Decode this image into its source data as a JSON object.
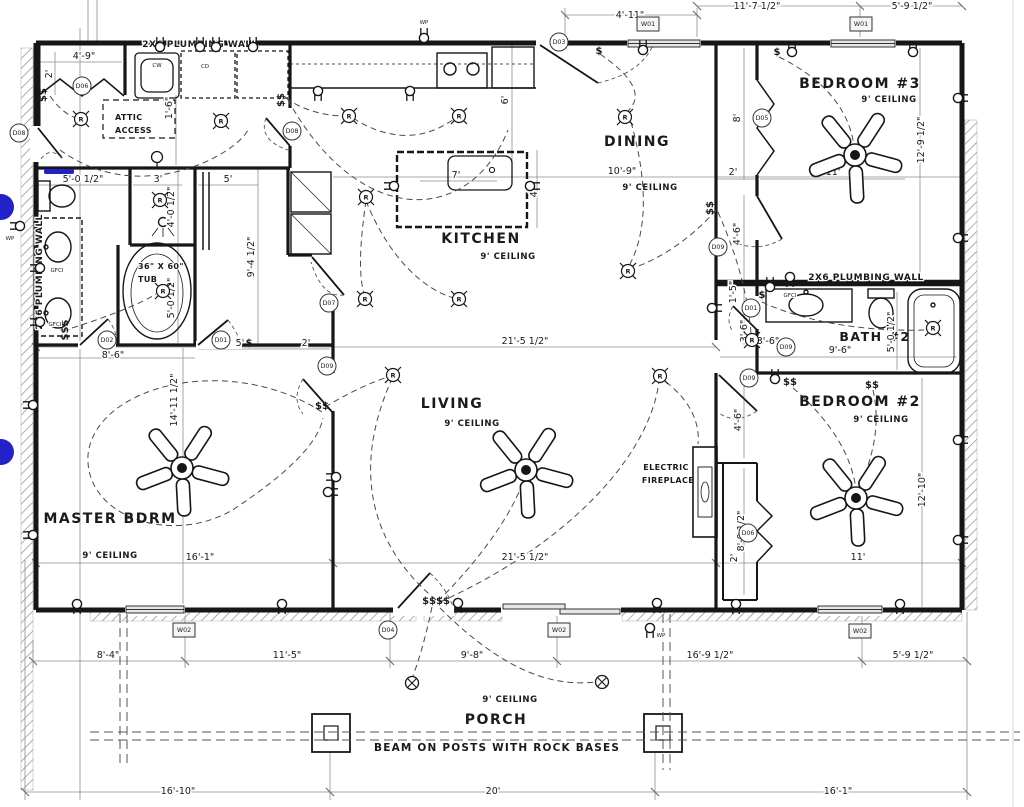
{
  "colors": {
    "ink": "#161616",
    "gray_line": "#8f8f8f",
    "window_fill": "#e6e6e6",
    "accent_blue": "#2222c8"
  },
  "rooms": {
    "master": {
      "name": "MASTER BDRM",
      "ceiling": "9' CEILING"
    },
    "living": {
      "name": "LIVING",
      "ceiling": "9' CEILING"
    },
    "kitchen": {
      "name": "KITCHEN",
      "ceiling": "9' CEILING"
    },
    "dining": {
      "name": "DINING",
      "ceiling": "9' CEILING"
    },
    "bedroom3": {
      "name": "BEDROOM #3",
      "ceiling": "9' CEILING"
    },
    "bedroom2": {
      "name": "BEDROOM #2",
      "ceiling": "9' CEILING"
    },
    "bath2": {
      "name": "BATH #2"
    },
    "porch": {
      "name": "PORCH",
      "ceiling": "9' CEILING"
    }
  },
  "notes": {
    "plumbing_top": "2X6 PLUMBING WALL",
    "plumbing_left": "2X6 PLUMBING WALL",
    "plumbing_bath2": "2X6 PLUMBING WALL",
    "attic_l1": "ATTIC",
    "attic_l2": "ACCESS",
    "tub_l1": "36\" X 60\"",
    "tub_l2": "TUB",
    "fireplace_l1": "ELECTRIC",
    "fireplace_l2": "FIREPLACE",
    "beam": "BEAM ON POSTS WITH ROCK BASES"
  },
  "dimensions": [
    {
      "t": "4'-11\"",
      "x": 630,
      "y": 18,
      "r": 0
    },
    {
      "t": "11'-7 1/2\"",
      "x": 757,
      "y": 9,
      "r": 0
    },
    {
      "t": "5'-9 1/2\"",
      "x": 912,
      "y": 9,
      "r": 0
    },
    {
      "t": "4'-9\"",
      "x": 84,
      "y": 59,
      "r": 0
    },
    {
      "t": "2'",
      "x": 52,
      "y": 74,
      "r": -90
    },
    {
      "t": "5'-0 1/2\"",
      "x": 83,
      "y": 182,
      "r": 0
    },
    {
      "t": "3'",
      "x": 158,
      "y": 182,
      "r": 0
    },
    {
      "t": "5'",
      "x": 228,
      "y": 182,
      "r": 0
    },
    {
      "t": "4'-0 1/2\"",
      "x": 174,
      "y": 207,
      "r": -90
    },
    {
      "t": "1'-6\"",
      "x": 172,
      "y": 108,
      "r": -90
    },
    {
      "t": "9'-4 1/2\"",
      "x": 254,
      "y": 257,
      "r": -90
    },
    {
      "t": "5'-0 1/2\"",
      "x": 174,
      "y": 298,
      "r": -90
    },
    {
      "t": "8'-6\"",
      "x": 113,
      "y": 358,
      "r": 0
    },
    {
      "t": "5'",
      "x": 240,
      "y": 346,
      "r": 0
    },
    {
      "t": "2'",
      "x": 306,
      "y": 346,
      "r": 0
    },
    {
      "t": "6'",
      "x": 508,
      "y": 100,
      "r": -90
    },
    {
      "t": "7'",
      "x": 456,
      "y": 178,
      "r": 0
    },
    {
      "t": "4'",
      "x": 537,
      "y": 193,
      "r": -90
    },
    {
      "t": "10'-9\"",
      "x": 622,
      "y": 174,
      "r": 0
    },
    {
      "t": "12'-9 1/2\"",
      "x": 924,
      "y": 140,
      "r": -90
    },
    {
      "t": "11'",
      "x": 833,
      "y": 175,
      "r": 0
    },
    {
      "t": "2'",
      "x": 733,
      "y": 175,
      "r": 0
    },
    {
      "t": "8'",
      "x": 740,
      "y": 118,
      "r": -90
    },
    {
      "t": "4'-6\"",
      "x": 740,
      "y": 234,
      "r": -90
    },
    {
      "t": "1'-5\"",
      "x": 736,
      "y": 292,
      "r": -90
    },
    {
      "t": "3'-6\"",
      "x": 747,
      "y": 331,
      "r": -90
    },
    {
      "t": "3'-6\"",
      "x": 768,
      "y": 344,
      "r": 0
    },
    {
      "t": "9'-6\"",
      "x": 840,
      "y": 353,
      "r": 0
    },
    {
      "t": "5'-0 1/2\"",
      "x": 894,
      "y": 332,
      "r": -90
    },
    {
      "t": "21'-5 1/2\"",
      "x": 525,
      "y": 344,
      "r": 0
    },
    {
      "t": "21'-5 1/2\"",
      "x": 525,
      "y": 560,
      "r": 0
    },
    {
      "t": "14'-11 1/2\"",
      "x": 177,
      "y": 400,
      "r": -90
    },
    {
      "t": "16'-1\"",
      "x": 200,
      "y": 560,
      "r": 0
    },
    {
      "t": "4'-6\"",
      "x": 741,
      "y": 420,
      "r": -90
    },
    {
      "t": "8'-0 1/2\"",
      "x": 744,
      "y": 531,
      "r": -90
    },
    {
      "t": "2'",
      "x": 737,
      "y": 558,
      "r": -90
    },
    {
      "t": "12'-10\"",
      "x": 925,
      "y": 490,
      "r": -90
    },
    {
      "t": "11'",
      "x": 858,
      "y": 560,
      "r": 0
    },
    {
      "t": "8'-4\"",
      "x": 108,
      "y": 658,
      "r": 0
    },
    {
      "t": "11'-5\"",
      "x": 287,
      "y": 658,
      "r": 0
    },
    {
      "t": "9'-8\"",
      "x": 472,
      "y": 658,
      "r": 0
    },
    {
      "t": "16'-9 1/2\"",
      "x": 710,
      "y": 658,
      "r": 0
    },
    {
      "t": "5'-9 1/2\"",
      "x": 913,
      "y": 658,
      "r": 0
    },
    {
      "t": "16'-10\"",
      "x": 178,
      "y": 794,
      "r": 0
    },
    {
      "t": "20'",
      "x": 493,
      "y": 794,
      "r": 0
    },
    {
      "t": "16'-1\"",
      "x": 838,
      "y": 794,
      "r": 0
    }
  ],
  "door_tags": [
    {
      "t": "D06",
      "x": 82,
      "y": 86
    },
    {
      "t": "D08",
      "x": 19,
      "y": 133
    },
    {
      "t": "D08",
      "x": 292,
      "y": 131
    },
    {
      "t": "D03",
      "x": 559,
      "y": 42
    },
    {
      "t": "D05",
      "x": 762,
      "y": 118
    },
    {
      "t": "D02",
      "x": 107,
      "y": 340
    },
    {
      "t": "D01",
      "x": 221,
      "y": 340
    },
    {
      "t": "D07",
      "x": 329,
      "y": 303
    },
    {
      "t": "D09",
      "x": 327,
      "y": 366
    },
    {
      "t": "D09",
      "x": 718,
      "y": 247
    },
    {
      "t": "D01",
      "x": 751,
      "y": 308
    },
    {
      "t": "D09",
      "x": 786,
      "y": 347
    },
    {
      "t": "D09",
      "x": 749,
      "y": 378
    },
    {
      "t": "D06",
      "x": 748,
      "y": 533
    },
    {
      "t": "D04",
      "x": 388,
      "y": 630
    }
  ],
  "window_tags": [
    {
      "t": "W01",
      "x": 648,
      "y": 24
    },
    {
      "t": "W01",
      "x": 861,
      "y": 24
    },
    {
      "t": "W02",
      "x": 184,
      "y": 630
    },
    {
      "t": "W02",
      "x": 559,
      "y": 630
    },
    {
      "t": "W02",
      "x": 860,
      "y": 631
    }
  ],
  "electrical": {
    "outlets": [
      [
        424,
        38,
        0
      ],
      [
        643,
        50,
        0
      ],
      [
        792,
        52,
        0
      ],
      [
        913,
        52,
        0
      ],
      [
        160,
        47,
        0
      ],
      [
        200,
        47,
        0
      ],
      [
        216,
        47,
        0
      ],
      [
        253,
        47,
        0
      ],
      [
        318,
        91,
        180
      ],
      [
        410,
        91,
        180
      ],
      [
        394,
        186,
        270
      ],
      [
        530,
        186,
        90
      ],
      [
        20,
        226,
        270
      ],
      [
        33,
        405,
        270
      ],
      [
        33,
        535,
        270
      ],
      [
        77,
        604,
        180
      ],
      [
        282,
        604,
        180
      ],
      [
        328,
        492,
        90
      ],
      [
        336,
        477,
        270
      ],
      [
        458,
        603,
        180
      ],
      [
        657,
        603,
        180
      ],
      [
        712,
        308,
        90
      ],
      [
        958,
        98,
        90
      ],
      [
        958,
        238,
        90
      ],
      [
        790,
        277,
        180
      ],
      [
        770,
        287,
        0
      ],
      [
        775,
        379,
        0
      ],
      [
        958,
        440,
        90
      ],
      [
        958,
        540,
        90
      ],
      [
        736,
        604,
        180
      ],
      [
        900,
        604,
        180
      ],
      [
        40,
        268,
        270
      ],
      [
        40,
        322,
        270
      ],
      [
        650,
        628,
        180
      ]
    ],
    "switches": [
      {
        "t": "$$",
        "x": 46,
        "y": 95,
        "r": -90
      },
      {
        "t": "$$",
        "x": 284,
        "y": 100,
        "r": -90
      },
      {
        "t": "$",
        "x": 599,
        "y": 54,
        "r": 0
      },
      {
        "t": "$",
        "x": 777,
        "y": 55,
        "r": 0
      },
      {
        "t": "$$",
        "x": 713,
        "y": 208,
        "r": -90
      },
      {
        "t": "$$$",
        "x": 68,
        "y": 330,
        "r": -90
      },
      {
        "t": "$",
        "x": 249,
        "y": 346,
        "r": 0
      },
      {
        "t": "$$",
        "x": 322,
        "y": 409,
        "r": 0
      },
      {
        "t": "$$$$",
        "x": 436,
        "y": 604,
        "r": 0
      },
      {
        "t": "$$",
        "x": 790,
        "y": 385,
        "r": 0
      },
      {
        "t": "$$",
        "x": 872,
        "y": 388,
        "r": 0
      },
      {
        "t": "$",
        "x": 762,
        "y": 298,
        "r": 0
      }
    ],
    "recessed": [
      [
        81,
        119
      ],
      [
        221,
        121
      ],
      [
        349,
        116
      ],
      [
        459,
        116
      ],
      [
        625,
        117
      ],
      [
        366,
        197
      ],
      [
        365,
        299
      ],
      [
        459,
        299
      ],
      [
        160,
        200
      ],
      [
        163,
        291
      ],
      [
        393,
        375
      ],
      [
        660,
        376
      ],
      [
        628,
        271
      ],
      [
        752,
        340
      ],
      [
        933,
        328
      ]
    ],
    "porch_lights": [
      [
        412,
        683
      ],
      [
        602,
        682
      ]
    ],
    "ceiling_lights": [
      [
        157,
        157
      ]
    ],
    "fans": [
      [
        182,
        468
      ],
      [
        526,
        470
      ],
      [
        855,
        155
      ],
      [
        856,
        498
      ]
    ],
    "labels": [
      {
        "t": "WP",
        "x": 424,
        "y": 24
      },
      {
        "t": "WP",
        "x": 10,
        "y": 240
      },
      {
        "t": "WP",
        "x": 661,
        "y": 637
      },
      {
        "t": "GFCI",
        "x": 57,
        "y": 272
      },
      {
        "t": "GFCI",
        "x": 55,
        "y": 326
      },
      {
        "t": "GFCI",
        "x": 790,
        "y": 297
      },
      {
        "t": "CW",
        "x": 157,
        "y": 67
      },
      {
        "t": "CD",
        "x": 205,
        "y": 68
      }
    ]
  }
}
